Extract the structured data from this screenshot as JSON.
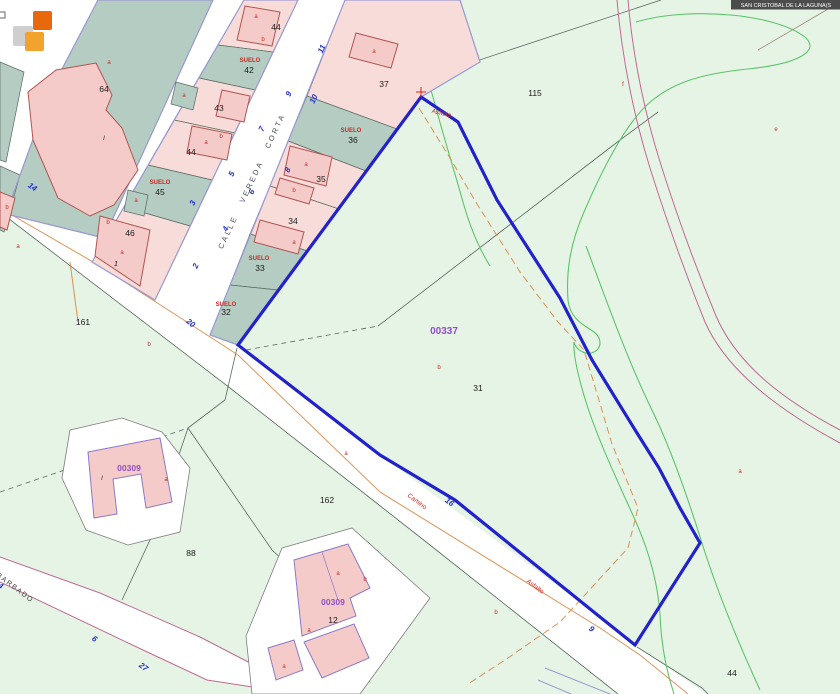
{
  "header": {
    "municipality_label": "SAN CRISTOBAL DE LA LAGUNA(S"
  },
  "map": {
    "street_name": "CALLE VEREDA CORTA",
    "selected_parcel_ref": "00337",
    "building_refs": {
      "ref_a": "00309",
      "ref_b": "00309"
    },
    "surface_label": "SUELO",
    "road_labels": {
      "camino": "Camino",
      "asfalto": "Asfalto",
      "asfalto_top": "Asfalto",
      "barbado": "BARBADO"
    },
    "parcel_numbers": {
      "p64": "64",
      "p44_top": "44",
      "p42": "42",
      "p43": "43",
      "p44": "44",
      "p45": "45",
      "p46": "46",
      "p37": "37",
      "p36": "36",
      "p35": "35",
      "p34": "34",
      "p33": "33",
      "p32": "32",
      "p115": "115",
      "p31": "31",
      "p161": "161",
      "p162": "162",
      "p88": "88",
      "p12": "12",
      "p44_br": "44",
      "p1": "1"
    },
    "street_numbers": {
      "n2": "2",
      "n3": "3",
      "n4": "4",
      "n5": "5",
      "n6": "6",
      "n7": "7",
      "n8": "8",
      "n9": "9",
      "n10": "10",
      "n11": "11",
      "n14": "14",
      "n16": "16",
      "n20": "20",
      "n27": "27",
      "n6b": "6",
      "n9b": "9",
      "n4b": "4"
    },
    "sub_letters": {
      "a": "a",
      "b": "b",
      "e": "e",
      "f": "f",
      "i": "I"
    }
  },
  "colors": {
    "selection_blue": "#2222cc",
    "street_number_blue": "#2233cc",
    "parcel_teal": "#b4ccc2",
    "parcel_pink": "#f8dcda",
    "building_pink": "#f5cbc9",
    "building_outline_red": "#b05552",
    "building_outline_violet": "#8a7ac8",
    "rural_green": "#e6f4e6",
    "contour_green": "#5cc46a",
    "road_magenta": "#c06a92",
    "path_orange": "#d8823c",
    "ref_purple": "#9050c8",
    "label_red": "#cc2a22",
    "border_violet": "#9a9ad2",
    "boundary_dark": "#5a6a60",
    "surround_gray": "#7d7d7d",
    "logo_gray": "#cfcfcf",
    "logo_orange": "#e8680e",
    "logo_amber": "#f2a32d",
    "header_bg": "#4c4c4c"
  }
}
